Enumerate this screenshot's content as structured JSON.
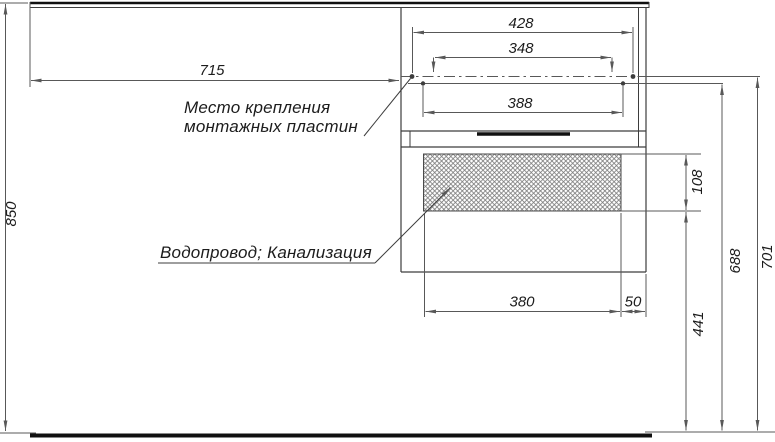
{
  "dimensions": {
    "mount_width_outer": "428",
    "mount_width_inner": "348",
    "mount_width_lower": "388",
    "offset_left": "715",
    "height_total": "850",
    "hatch_height": "108",
    "height_hatch_bottom": "441",
    "height_mount_lower": "688",
    "height_mount_upper": "701",
    "hatch_width": "380",
    "hatch_offset_right": "50"
  },
  "labels": {
    "mounting_plates_line1": "Место крепления",
    "mounting_plates_line2": "монтажных пластин",
    "plumbing": "Водопровод; Канализация"
  },
  "colors": {
    "line": "#3d3d3d",
    "dim_line": "#585858",
    "thick_line": "#101010",
    "text": "#1c1c1c",
    "hatch": "#7a7a7a",
    "background": "#ffffff"
  }
}
